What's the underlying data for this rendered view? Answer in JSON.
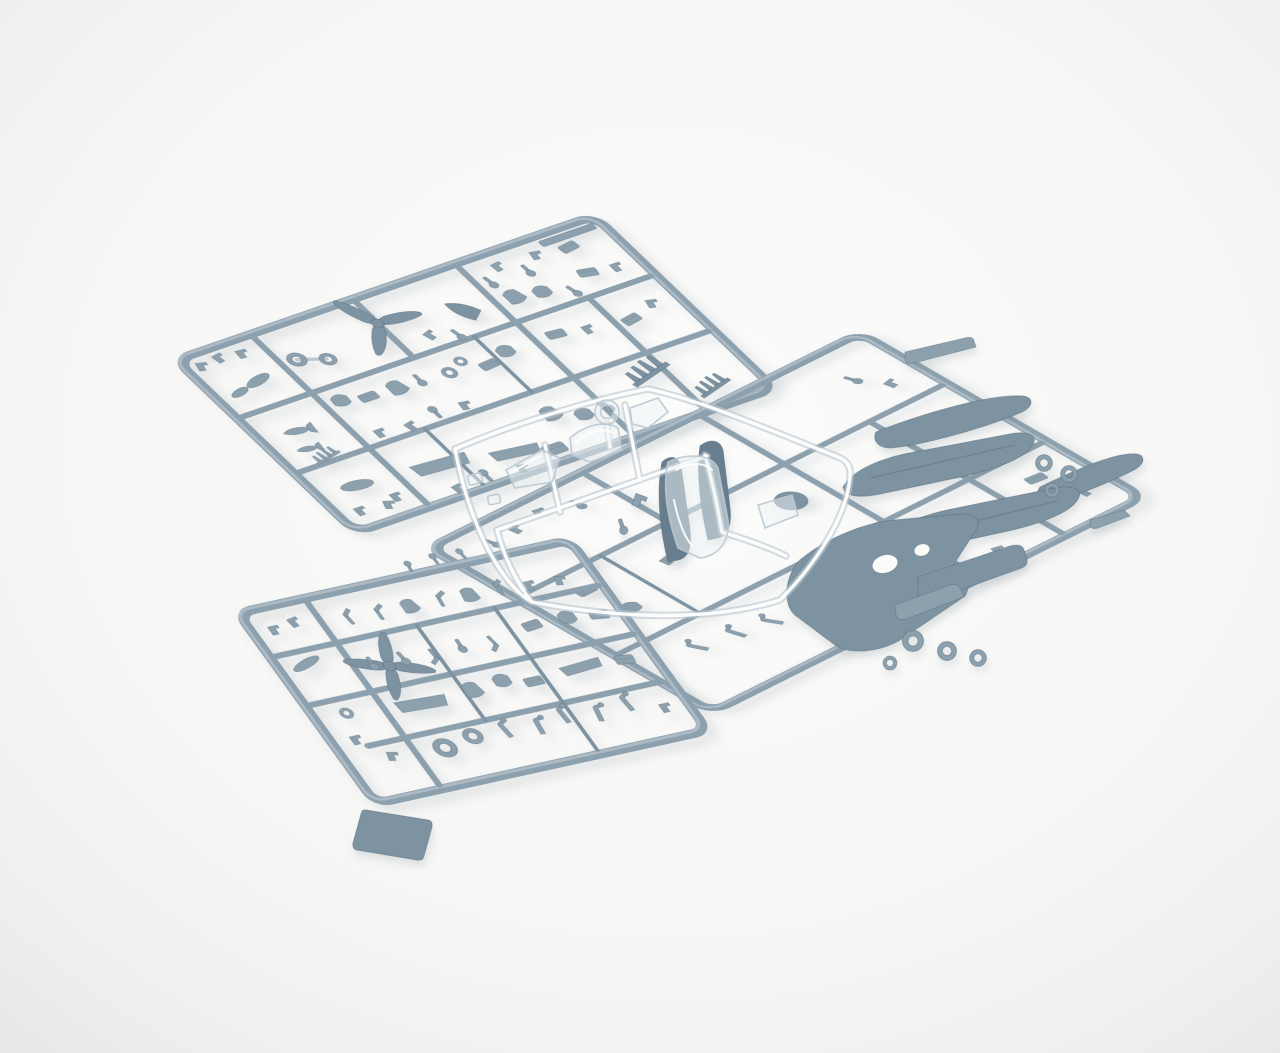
{
  "scene": {
    "type": "studio product photograph",
    "subject": "Injection-molded plastic model aircraft kit sprues laid on a seamless light backdrop",
    "sprue_count": 4,
    "no_visible_text": true
  },
  "colors": {
    "backdrop_center": "#fbfbfa",
    "backdrop_edge": "#efefed",
    "backdrop_corner": "#e7e8e6",
    "plastic_base": "#8da0ae",
    "plastic_light": "#b3c0c9",
    "plastic_mid": "#7e93a2",
    "plastic_dark": "#687e8e",
    "plastic_deep": "#546a7a",
    "clear_line": "#bac7d0",
    "clear_tint": "#eef3f6",
    "shadow": "#748391"
  },
  "sprues": [
    {
      "id": "sprue-top-left",
      "material": "blue-gray styrene",
      "position": "upper left, tilted",
      "contents": [
        "three-blade propeller",
        "spinner cone",
        "twin-ring part",
        "rows of cockpit detail parts",
        "exhaust stack combs",
        "small bombs and drop tank",
        "instrument panels",
        "sidewall panels"
      ]
    },
    {
      "id": "sprue-right",
      "material": "blue-gray styrene",
      "position": "right, tilted",
      "contents": [
        "two fuselage halves",
        "two upper wing halves",
        "one-piece lower wing",
        "flap panel",
        "windshield deck part",
        "main wheel rings",
        "nose-down fuselage pair",
        "landing gear legs",
        "round runner joint"
      ]
    },
    {
      "id": "sprue-bottom-left",
      "material": "blue-gray styrene",
      "position": "lower left, tilted",
      "contents": [
        "four-blade propeller",
        "rows of seats and control levers",
        "bulkheads",
        "cockpit floor",
        "wheel rings",
        "landing gear legs",
        "thick ventral plate"
      ]
    },
    {
      "id": "sprue-clear",
      "material": "transparent styrene",
      "position": "center, overlapping the gray sprues",
      "contents": [
        "windscreen",
        "canopy hood",
        "rear glazing",
        "large canopy section",
        "gunsight ring",
        "small clear lights",
        "quarter window"
      ]
    }
  ]
}
